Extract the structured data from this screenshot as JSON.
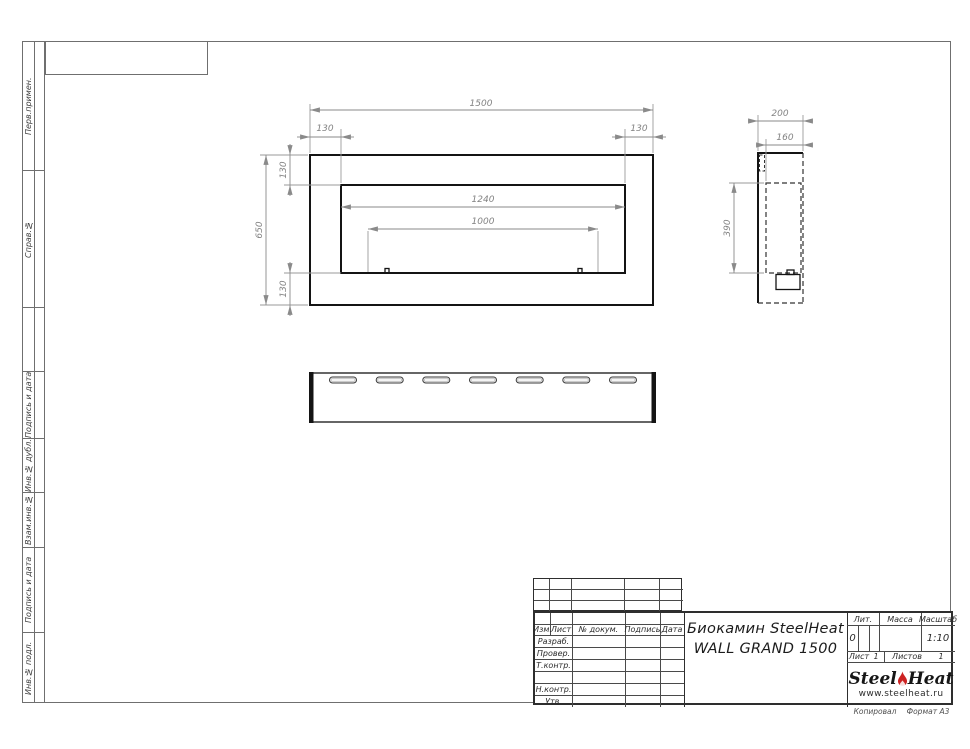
{
  "sheet": {
    "copied_label": "Копировал",
    "format_label": "Формат А3"
  },
  "sidebar": {
    "sections": [
      {
        "label": "Перв.примен."
      },
      {
        "label": "Справ.№"
      },
      {
        "label": ""
      },
      {
        "label": "Подпись и дата"
      },
      {
        "label": "Инв.№ дубл."
      },
      {
        "label": "Взам.инв.№"
      },
      {
        "label": "Подпись и дата"
      },
      {
        "label": "Инв.№ подл."
      }
    ]
  },
  "title_block": {
    "header": {
      "izm": "Изм.",
      "list": "Лист",
      "doc": "№ докум.",
      "sign": "Подпись",
      "date": "Дата"
    },
    "roles": {
      "developed": "Разраб.",
      "checked": "Провер.",
      "tcontrol": "Т.контр.",
      "ncontrol": "Н.контр.",
      "approved": "Утв."
    },
    "title_line1": "Биокамин SteelHeat",
    "title_line2": "WALL GRAND 1500",
    "lit_label": "Лит.",
    "lit_value": "0",
    "mass_label": "Масса",
    "mass_value": "",
    "scale_label": "Масштаб",
    "scale_value": "1:10",
    "sheet_label": "Лист",
    "sheet_value": "1",
    "sheets_label": "Листов",
    "sheets_value": "1",
    "logo": {
      "word1": "Steel",
      "word2": "Heat",
      "url": "www.steelheat.ru"
    }
  },
  "drawing": {
    "labels": {
      "front_width": "1500",
      "front_height": "650",
      "flange": "130",
      "opening_width": "1240",
      "burner_width": "1000",
      "depth": "200",
      "inner_depth": "160",
      "opening_height": "390"
    },
    "views": {
      "bottom": {
        "slot_count": 7
      }
    }
  },
  "colors": {
    "flame": "#cc2222"
  }
}
